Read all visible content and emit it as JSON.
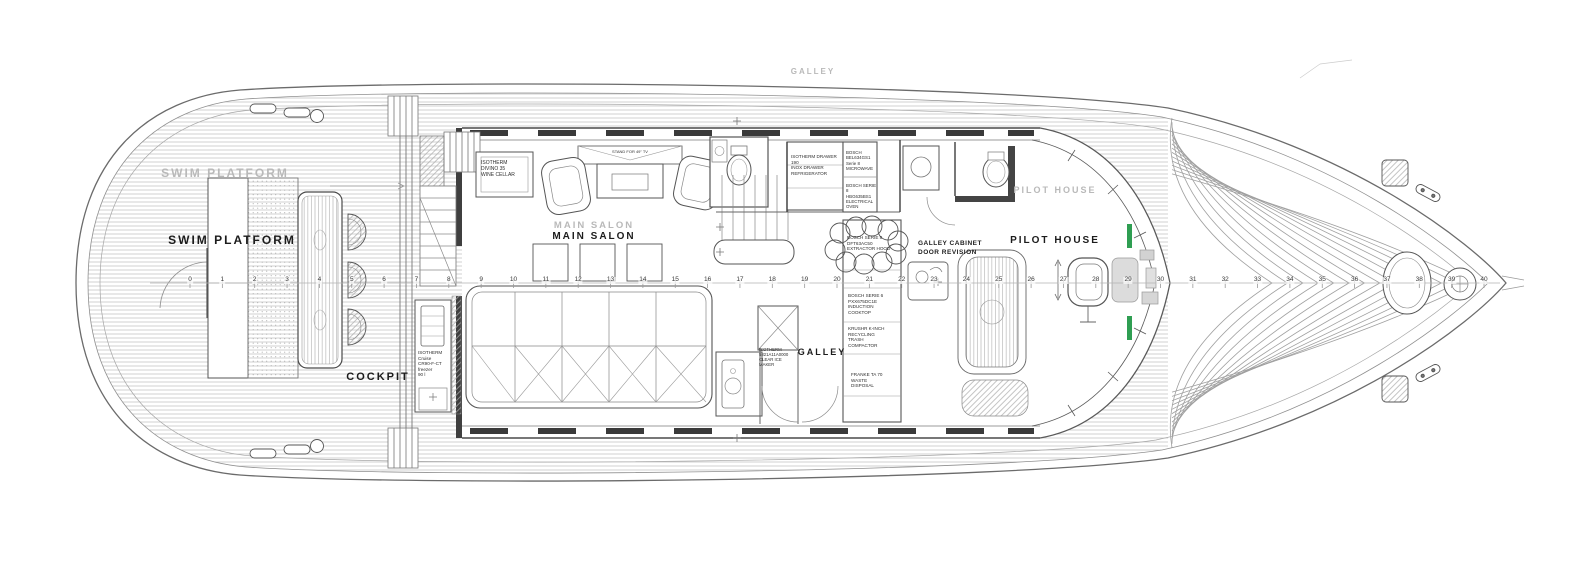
{
  "labels": {
    "swim_platform_ghost": "SWIM PLATFORM",
    "swim_platform": "SWIM PLATFORM",
    "cockpit": "COCKPIT",
    "main_salon_ghost": "MAIN SALON",
    "main_salon": "MAIN SALON",
    "galley_deck_ghost": "GALLEY",
    "galley": "GALLEY",
    "pilot_house_ghost": "PILOT HOUSE",
    "pilot_house": "PILOT HOUSE"
  },
  "annotations": {
    "galley_revision": "GALLEY CABINET\nDOOR REVISION"
  },
  "equipment": {
    "wine_cellar": "ISOTHERM\nDIVINO 35\nWINE CELLAR",
    "tv_stand": "STAND FOR 49\" TV",
    "freezer": "ISOTHERM\nCruise\nCR90-F-CT\nfreezer\n90 l",
    "drawer_fridge": "ISOTHERM DRAWER 190\nINOX DRAWER\nREFRIGERATOR",
    "microwave": "BOSCH\nBEL634GS1\nSerie 8\nMICROWAVE",
    "oven": "BOSCH SERIE 8\nHBG635BS1\nELECTRICAL\nOVEN",
    "hood": "BOSCH SERIE 8\nDFT63AC50\nEXTRACTOR HOOD",
    "induction": "BOSCH SERIE 6\nPXX675DC1E\nINDUCTION\nCOOKTOP",
    "trash": "KRUSHR K-INCH\nRECYCLING\nTRASH\nCOMPACTOR",
    "ice_maker": "ISOTHERM\n5821A11A0000\nCLEAR ICE\nMAKER",
    "waste": "FRANKE TA 70\nWASTE\nDISPOSAL"
  },
  "stations": {
    "numbers": [
      0,
      1,
      2,
      3,
      4,
      5,
      6,
      7,
      8,
      9,
      10,
      11,
      12,
      13,
      14,
      15,
      16,
      17,
      18,
      19,
      20,
      21,
      22,
      23,
      24,
      25,
      26,
      27,
      28,
      29,
      30,
      31,
      32,
      33,
      34,
      35,
      36,
      37,
      38,
      39,
      40
    ]
  },
  "colors": {
    "instrument_green": "#2f9e52"
  }
}
